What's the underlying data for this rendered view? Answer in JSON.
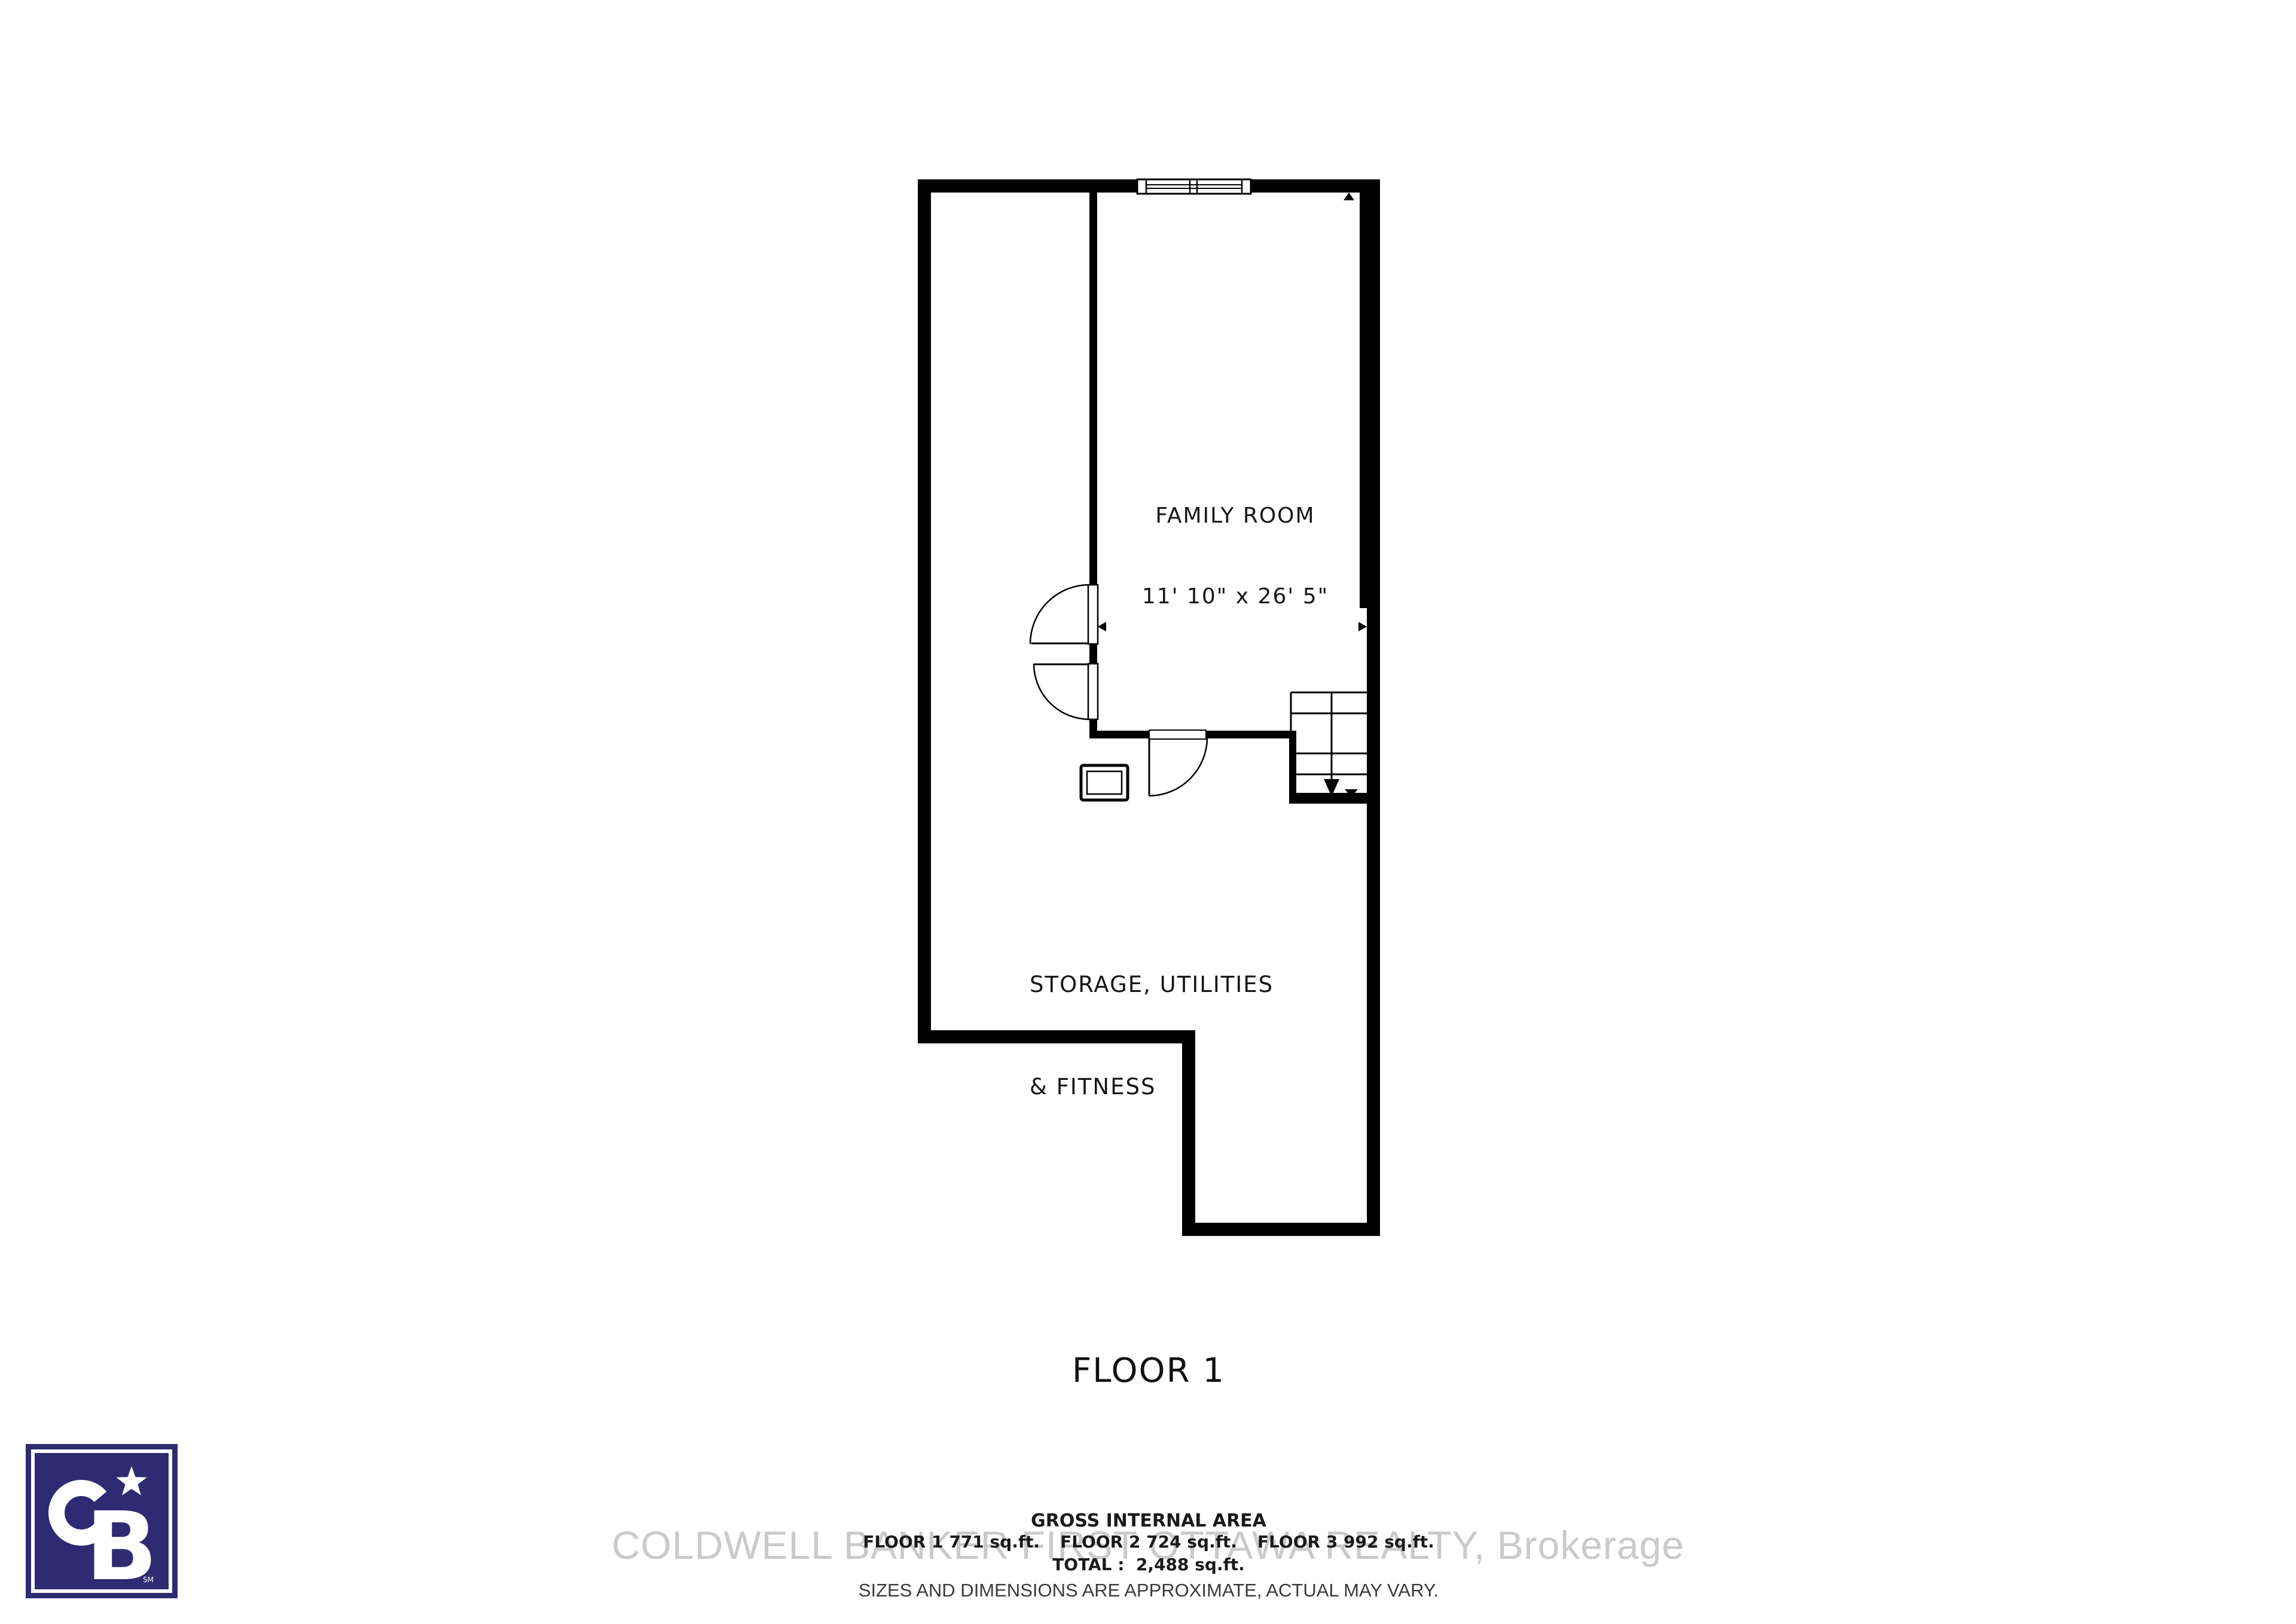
{
  "page": {
    "background_color": "#ffffff"
  },
  "plan": {
    "title": "FLOOR 1",
    "wall_color": "#000000",
    "rooms": {
      "family_room": {
        "name": "FAMILY ROOM",
        "dimensions": "11' 10\" x 26' 5\""
      },
      "storage": {
        "name_line1": "STORAGE, UTILITIES",
        "name_line2": "& FITNESS"
      }
    },
    "symbols": [
      "window",
      "double-door-swing",
      "single-door-swing",
      "staircase-down",
      "utility-box",
      "direction-arrows"
    ]
  },
  "area_summary": {
    "heading": "GROSS INTERNAL AREA",
    "floor1": "FLOOR 1 771 sq.ft.",
    "floor2": "FLOOR 2 724 sq.ft.",
    "floor3": "FLOOR 3 992 sq.ft.",
    "total": "TOTAL :  2,488 sq.ft.",
    "disclaimer": "SIZES AND DIMENSIONS ARE APPROXIMATE, ACTUAL MAY VARY."
  },
  "watermark": {
    "text": "COLDWELL BANKER FIRST OTTAWA REALTY, Brokerage",
    "color": "#cacaca"
  },
  "logo": {
    "monogram": "CB",
    "letter_b": "B",
    "service_mark": "SM",
    "background_color": "#2e2b72",
    "foreground_color": "#ffffff"
  }
}
